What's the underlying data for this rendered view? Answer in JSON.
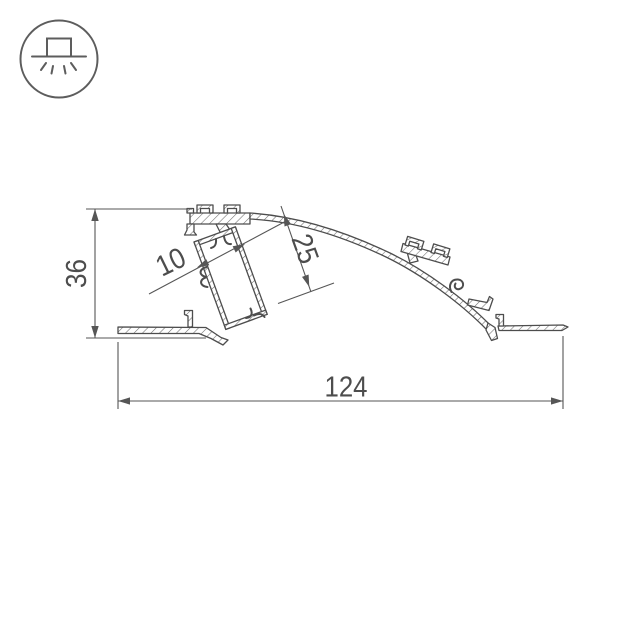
{
  "icon": {
    "name": "recessed-ceiling-light-icon"
  },
  "drawing": {
    "dimensions": {
      "overall_height": "36",
      "overall_width": "124",
      "led_slot_width": "10",
      "channel_depth": "25"
    },
    "colors": {
      "line": "#4d4d4d",
      "dimension_line": "#565656",
      "hatch": "#6e6e6e",
      "background": "#ffffff"
    }
  }
}
